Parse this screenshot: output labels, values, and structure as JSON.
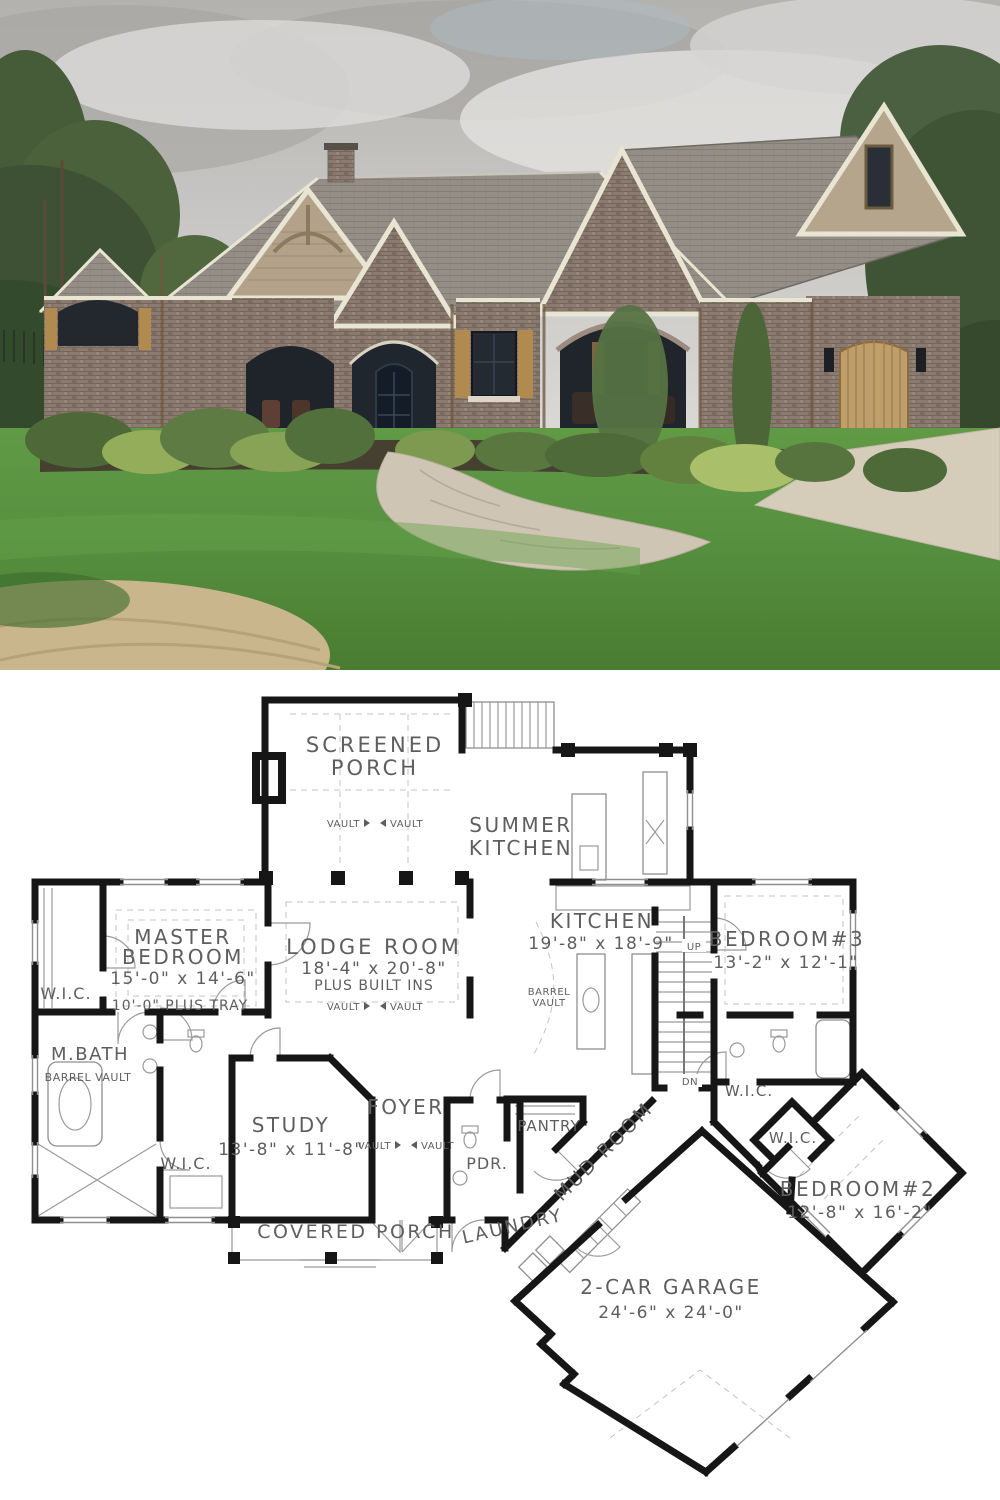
{
  "photo": {
    "palette": {
      "sky": "#c1c0be",
      "cloud_light": "#e0dfdd",
      "cloud_dark": "#a4a29f",
      "tree_dark": "#3e5233",
      "tree_mid": "#546a3e",
      "roof": "#938d86",
      "trim": "#e9e5d3",
      "brick": "#8a7a6f",
      "siding": "#b3a289",
      "shutter": "#b08a4e",
      "door": "#1c232e",
      "lawn": "#579040",
      "walkway": "#cfc5b4",
      "mulch": "#45402f",
      "driveway": "#d6ccba",
      "straw": "#c9b68c"
    }
  },
  "plan": {
    "ink": "#5e5e5e",
    "wall_color": "#161616",
    "labels": {
      "screened_porch_1": "SCREENED",
      "screened_porch_2": "PORCH",
      "vault": "VAULT",
      "summer_kitchen_1": "SUMMER",
      "summer_kitchen_2": "KITCHEN",
      "master_1": "MASTER",
      "master_2": "BEDROOM",
      "master_dims": "15'-0\" x 14'-6\"",
      "master_note": "10'-0\" PLUS TRAY",
      "wic": "W.I.C.",
      "lodge_1": "LODGE ROOM",
      "lodge_dims": "18'-4\" x 20'-8\"",
      "lodge_note": "PLUS BUILT INS",
      "kitchen_1": "KITCHEN",
      "kitchen_dims": "19'-8\" x 18'-9\"",
      "barrel_1": "BARREL",
      "barrel_2": "VAULT",
      "up": "UP",
      "dn": "DN",
      "bed3_1": "BEDROOM#3",
      "bed3_dims": "13'-2\" x 12'-1\"",
      "mbath_1": "M.BATH",
      "mbath_note": "BARREL VAULT",
      "study_1": "STUDY",
      "study_dims": "13'-8\" x 11'-8\"",
      "foyer_1": "FOYER",
      "pdr": "PDR.",
      "pantry": "PANTRY",
      "mud_room": "MUD ROOM",
      "bed2_1": "BEDROOM#2",
      "bed2_dims": "12'-8\" x 16'-2\"",
      "covered_porch": "COVERED PORCH",
      "laundry": "LAUNDRY",
      "garage_1": "2-CAR GARAGE",
      "garage_dims": "24'-6\" x 24'-0\""
    }
  }
}
